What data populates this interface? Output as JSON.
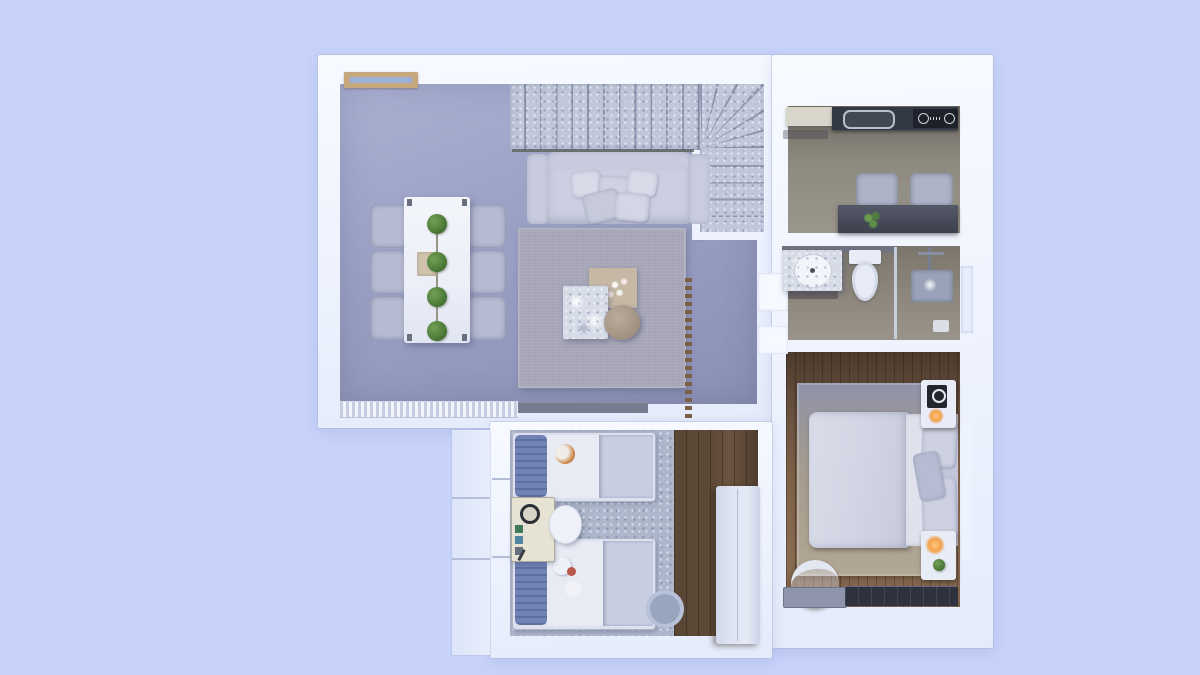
{
  "scene": {
    "type": "3d-floorplan-top-view-render",
    "description": "Top-down 3D render of an apartment floor plan on a light periwinkle background; no visible text in the image",
    "lighting": "cool blue daylight tint"
  },
  "palette": {
    "background": "#c7d3fa",
    "wall": "#edf2fe",
    "livingFloor": "#9aa0c4",
    "livingFloorLight": "#abb1d2",
    "livingRug": "#a5a4b6",
    "stairTread": "#c1c7da",
    "stairGap": "#8f96ae",
    "sofa": "#c9ccde",
    "diningTable": "#eceef8",
    "chair": "#b6bbd1",
    "plantGreen": "#4c7a38",
    "woodTrim": "#c7a87e",
    "kitchenFloor": "#8e8a80",
    "counterDark": "#333845",
    "cooktop": "#1d212a",
    "kitchenTable": "#474b59",
    "bathFloor": "#8e877d",
    "marble": "#d6dbe7",
    "fixtureWhite": "#e8ecf6",
    "glass": "#cfdaf0",
    "showerGray": "#99a2b8",
    "bedroomWood": "#6b5340",
    "bedroomRug": "#ab9f90",
    "duvet": "#d2d5e3",
    "nightstand": "#e8ecf7",
    "lampGlow": "#f2a14e",
    "dresserDark": "#2e323e",
    "kidsRug": "#adb6ca",
    "kidsWood": "#5d4936",
    "kidsBed": "#dde1ee",
    "kidsPillow": "#7183b5",
    "wardrobe": "#dde2f1",
    "deskCream": "#e7e3d4",
    "toyOrange": "#c97f3e",
    "toyRed": "#b8574a"
  },
  "rooms": [
    {
      "id": "living-dining",
      "furniture": [
        "l-shaped-staircase",
        "sofa-with-cushions",
        "area-rug",
        "marble-coffee-table",
        "beige-side-table-with-flowers",
        "round-pouf",
        "white-dining-table",
        "dining-chairs-x6",
        "table-planters-x4",
        "wood-framed-window",
        "louvered-floor-vent",
        "media-bench",
        "slatted-room-divider"
      ]
    },
    {
      "id": "kitchen",
      "furniture": [
        "dark-counter",
        "inset-sink",
        "cooktop-2-burners",
        "side-cabinet",
        "dark-dining-table",
        "chairs-x2",
        "small-plant"
      ]
    },
    {
      "id": "bathroom",
      "furniture": [
        "marble-vanity",
        "round-basin",
        "toilet",
        "glass-shower-partition",
        "shower-panel",
        "floor-drain",
        "window"
      ]
    },
    {
      "id": "bedroom",
      "furniture": [
        "double-bed",
        "pillows",
        "nightstand-x2",
        "lamps-warm-glow",
        "beige-rug",
        "round-chair",
        "bench",
        "dark-dresser",
        "wood-plank-floor"
      ]
    },
    {
      "id": "kids-room",
      "furniture": [
        "single-bed-x2",
        "blue-pillows",
        "plush-toys",
        "play-cabinet",
        "round-side-table",
        "tall-wardrobe",
        "speckled-rug",
        "round-rug",
        "wood-plank-floor"
      ]
    }
  ],
  "counts": {
    "dining_chairs": 6,
    "table_planters": 4,
    "kitchen_chairs": 2,
    "stair_treads_upper_run": 12,
    "stair_treads_lower_run": 5,
    "kids_beds": 2,
    "nightstands": 2
  }
}
